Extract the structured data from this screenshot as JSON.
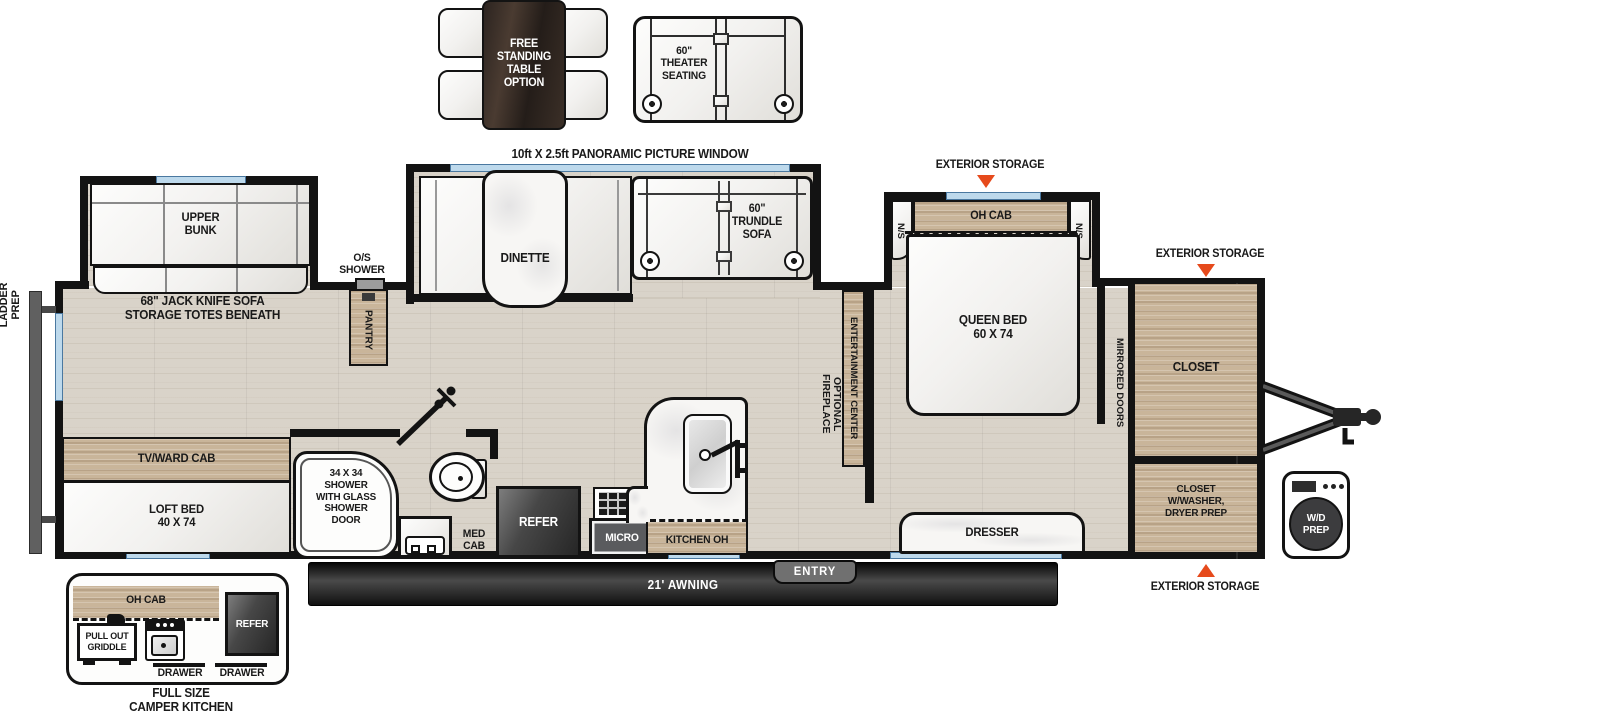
{
  "colors": {
    "accent_triangle": "#e64a1c",
    "wall": "#131313",
    "wood": "#c9b59a",
    "window_glass": "#bdd9ec",
    "floor": "#d9d3c9"
  },
  "options": {
    "free_standing_table": "FREE\nSTANDING\nTABLE\nOPTION",
    "theater_seating": "60\"\nTHEATER\nSEATING"
  },
  "callouts": {
    "panoramic_window": "10ft X 2.5ft PANORAMIC PICTURE WINDOW",
    "ladder_prep": "LADDER\nPREP",
    "exterior_storage_bedroom": "EXTERIOR STORAGE",
    "exterior_storage_front_top": "EXTERIOR STORAGE",
    "exterior_storage_front_bottom": "EXTERIOR STORAGE",
    "awning": "21' AWNING",
    "entry": "ENTRY",
    "wd_prep": "W/D\nPREP"
  },
  "living": {
    "upper_bunk": "UPPER\nBUNK",
    "jack_knife_sofa": "68\" JACK KNIFE SOFA\nSTORAGE TOTES BENEATH",
    "tv_ward_cab": "TV/WARD CAB",
    "loft_bed": "LOFT BED\n40 X 74",
    "dinette": "DINETTE",
    "trundle_sofa": "60\"\nTRUNDLE\nSOFA",
    "entertainment_center": "ENTERTAINMENT CENTER",
    "optional_fireplace": "OPTIONAL\nFIREPLACE",
    "os_shower": "O/S\nSHOWER",
    "pantry": "PANTRY"
  },
  "bathroom": {
    "shower": "34 X 34\nSHOWER\nWITH GLASS\nSHOWER\nDOOR",
    "med_cab": "MED\nCAB"
  },
  "kitchen": {
    "refer": "REFER",
    "micro": "MICRO",
    "kitchen_oh": "KITCHEN OH"
  },
  "bedroom": {
    "queen_bed": "QUEEN BED\n60 X 74",
    "oh_cab": "OH CAB",
    "ns_left": "N/S",
    "ns_right": "N/S",
    "mirrored_doors": "MIRRORED DOORS",
    "dresser": "DRESSER",
    "closet": "CLOSET",
    "closet_washer": "CLOSET\nW/WASHER,\nDRYER PREP"
  },
  "camper_kitchen": {
    "caption": "FULL SIZE\nCAMPER KITCHEN",
    "oh_cab": "OH CAB",
    "pull_out_griddle": "PULL OUT\nGRIDDLE",
    "refer": "REFER",
    "drawer_left": "DRAWER",
    "drawer_right": "DRAWER"
  }
}
